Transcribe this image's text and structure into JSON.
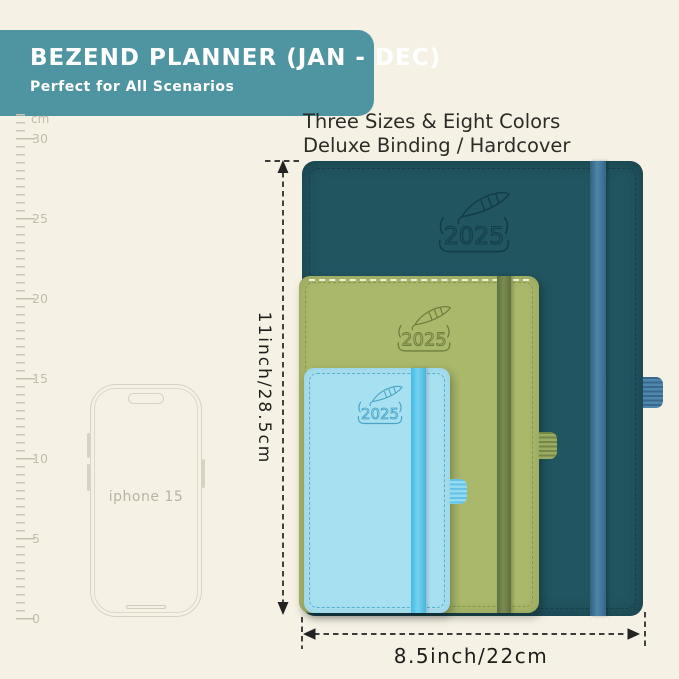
{
  "background_color": "#f5f1e4",
  "banner": {
    "title": "BEZEND PLANNER (JAN - DEC)",
    "subtitle": "Perfect for All Scenarios",
    "bg_color": "#4f94a1",
    "text_color": "#ffffff"
  },
  "tagline": {
    "line1": "Three Sizes & Eight Colors",
    "line2": "Deluxe Binding / Hardcover"
  },
  "ruler": {
    "unit": "cm",
    "labels": [
      "30",
      "25",
      "20",
      "15",
      "10",
      "5",
      "0"
    ]
  },
  "phone": {
    "label": "iphone 15"
  },
  "planners": [
    {
      "name": "large-planner",
      "year": "2025",
      "emblem_icon": "feather",
      "cover_color": "#215560",
      "strap_color": "#47809f"
    },
    {
      "name": "medium-planner",
      "year": "2025",
      "emblem_icon": "feather",
      "cover_color": "#a9b86b",
      "strap_color": "#6c7f47"
    },
    {
      "name": "small-planner",
      "year": "2025",
      "emblem_icon": "feather",
      "cover_color": "#a7e0f1",
      "strap_color": "#58c5ea"
    }
  ],
  "dimensions": {
    "height_label": "11inch/28.5cm",
    "width_label": "8.5inch/22cm"
  }
}
